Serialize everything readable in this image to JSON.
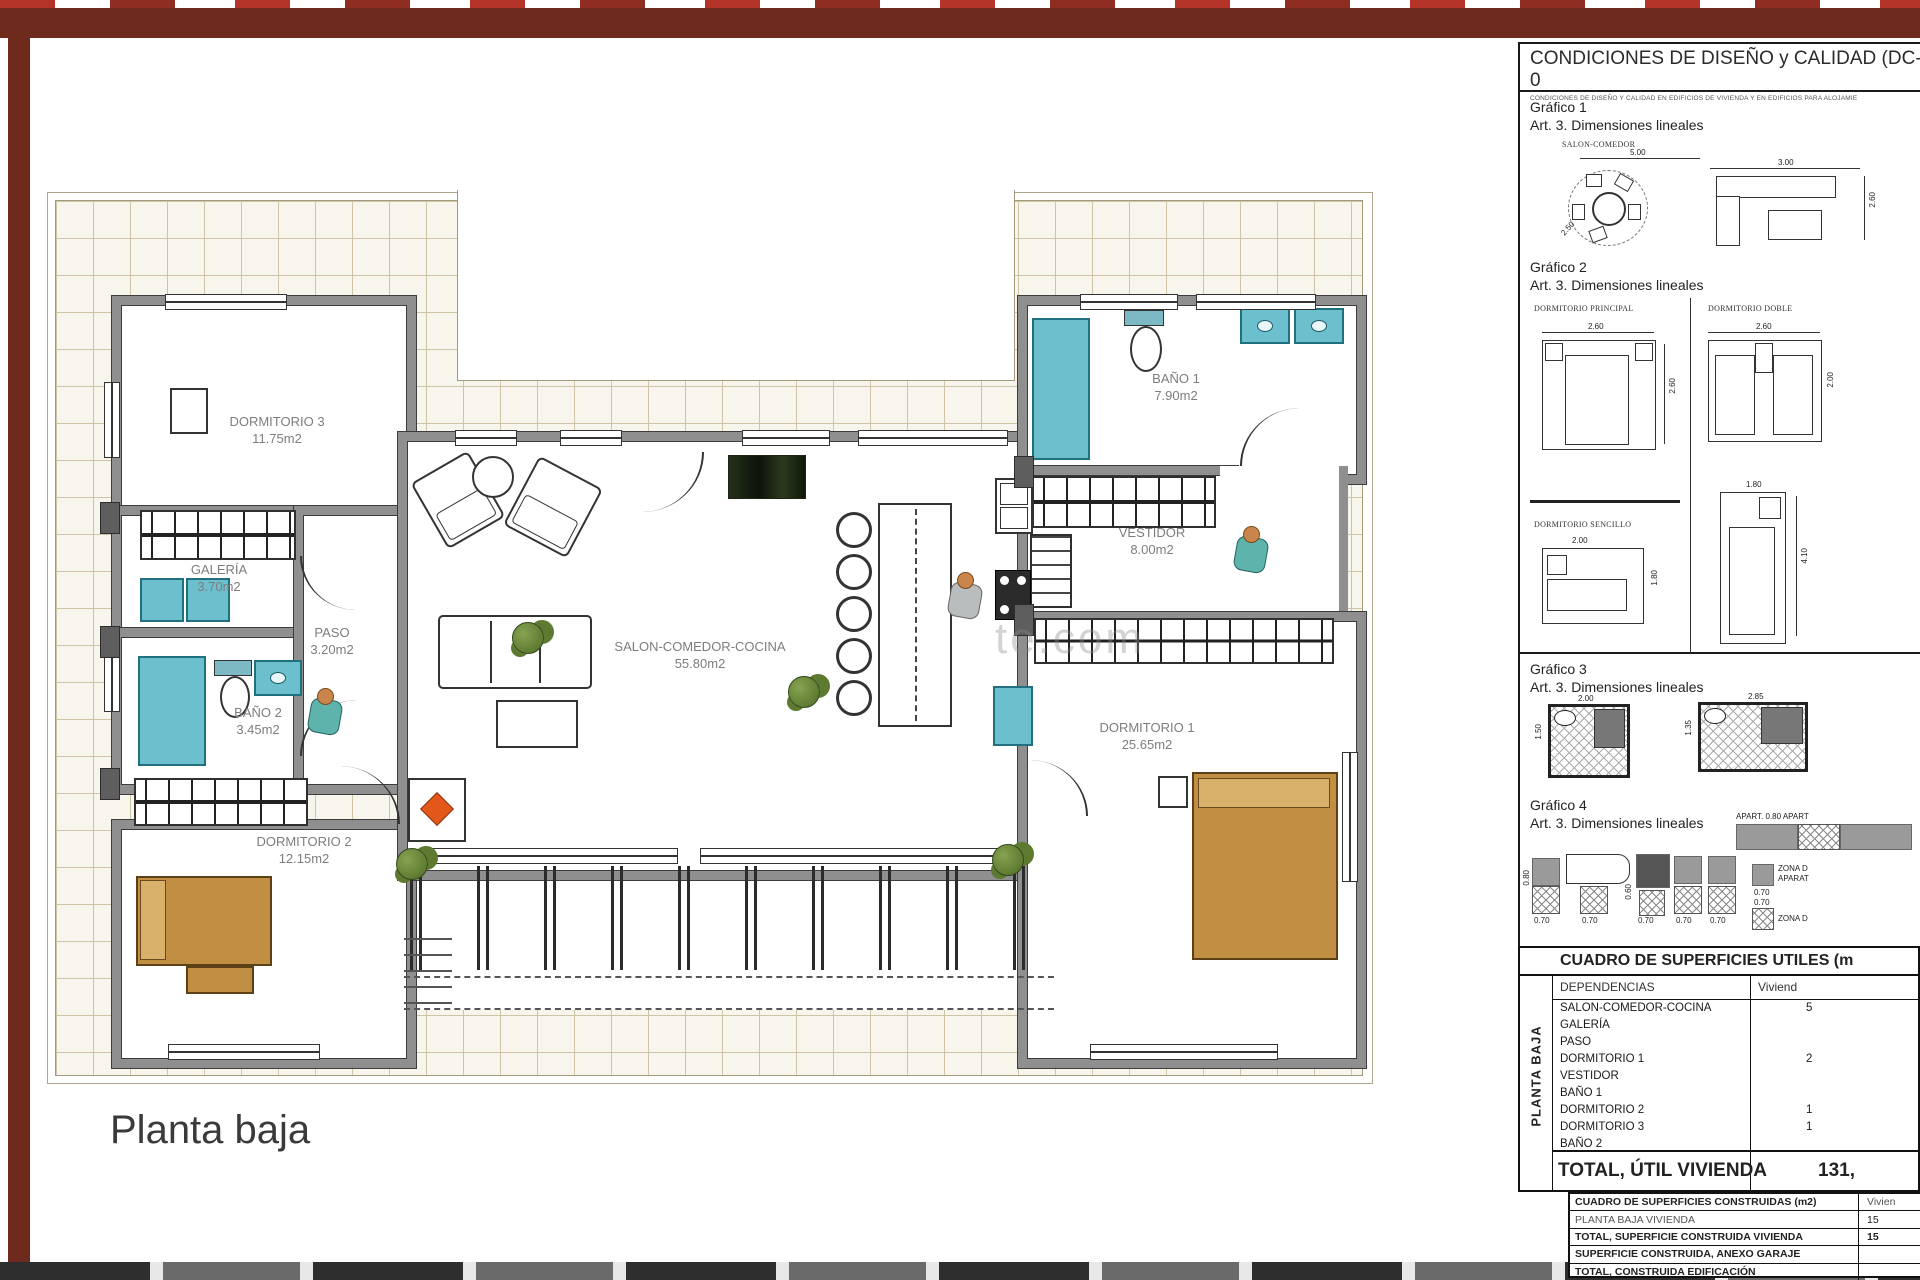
{
  "colors": {
    "frame": "#6e2b1d",
    "accent_red": "#b5342a",
    "teal": "#6cc0cd",
    "bed_brown": "#c08f43",
    "wall_gray": "#8f8f8f",
    "tile_line": "#cfc4a6",
    "label_gray": "#7d7d7d"
  },
  "plan": {
    "floor_label": "Planta baja",
    "watermark": "te.com",
    "rooms": [
      {
        "name": "DORMITORIO 3",
        "area": "11.75m2"
      },
      {
        "name": "GALERÍA",
        "area": "3.70m2"
      },
      {
        "name": "PASO",
        "area": "3.20m2"
      },
      {
        "name": "BAÑO 2",
        "area": "3.45m2"
      },
      {
        "name": "DORMITORIO 2",
        "area": "12.15m2"
      },
      {
        "name": "SALON-COMEDOR-COCINA",
        "area": "55.80m2"
      },
      {
        "name": "BAÑO 1",
        "area": "7.90m2"
      },
      {
        "name": "VESTIDOR",
        "area": "8.00m2"
      },
      {
        "name": "DORMITORIO 1",
        "area": "25.65m2"
      }
    ]
  },
  "panel": {
    "title": "CONDICIONES DE DISEÑO y CALIDAD (DC-0",
    "subtitle": "CONDICIONES DE DISEÑO Y CALIDAD EN EDIFICIOS DE VIVIENDA Y EN EDIFICIOS PARA ALOJAMIE",
    "graficos": [
      {
        "name": "Gráfico 1",
        "law": "Art. 3. Dimensiones lineales",
        "caption": "SALON-COMEDOR",
        "dim_top": "5.00",
        "dim_top2": "3.00",
        "dim_right": "2.60",
        "dim_diag": "2.50"
      },
      {
        "name": "Gráfico 2",
        "law": "Art. 3. Dimensiones lineales",
        "principal": "DORMITORIO PRINCIPAL",
        "doble": "DORMITORIO DOBLE",
        "sencillo": "DORMITORIO SENCILLO",
        "dims": {
          "principal_w": "2.60",
          "principal_h": "2.60",
          "doble_w": "2.60",
          "doble_h": "2.00",
          "single_w": "1.80",
          "single_h": "4.10",
          "sencillo_w": "2.00",
          "sencillo_h": "1.80"
        }
      },
      {
        "name": "Gráfico 3",
        "law": "Art. 3. Dimensiones lineales",
        "bath1_w": "2.00",
        "bath1_h": "1.50",
        "bath2_w": "2.85",
        "bath2_h": "1.35"
      },
      {
        "name": "Gráfico 4",
        "law": "Art. 3. Dimensiones lineales",
        "apart_label": "APART. 0.80 APART",
        "zona1": "ZONA D",
        "zona1b": "APARAT",
        "zona2": "ZONA D",
        "bottom_dims": [
          "0.70",
          "0.70",
          "0.70",
          "0.70",
          "0.70"
        ],
        "left_dim": "0.80",
        "mid_dim": "0.60",
        "legend_dims": [
          "0.70",
          "0.70"
        ]
      }
    ],
    "surfaces": {
      "title": "CUADRO DE SUPERFICIES UTILES (m",
      "col_dep": "DEPENDENCIAS",
      "col_viv": "Viviend",
      "group": "PLANTA BAJA",
      "rows": [
        {
          "dep": "SALON-COMEDOR-COCINA",
          "val": "5"
        },
        {
          "dep": "GALERÍA",
          "val": ""
        },
        {
          "dep": "PASO",
          "val": ""
        },
        {
          "dep": "DORMITORIO 1",
          "val": "2"
        },
        {
          "dep": "VESTIDOR",
          "val": ""
        },
        {
          "dep": "BAÑO 1",
          "val": ""
        },
        {
          "dep": "DORMITORIO 2",
          "val": "1"
        },
        {
          "dep": "DORMITORIO 3",
          "val": "1"
        },
        {
          "dep": "BAÑO 2",
          "val": ""
        }
      ],
      "total_label": "TOTAL, ÚTIL VIVIENDA",
      "total_val": "131,"
    },
    "built": {
      "title": "CUADRO DE SUPERFICIES CONSTRUIDAS (m2)",
      "col_viv": "Vivien",
      "rows": [
        {
          "label": "PLANTA BAJA VIVIENDA",
          "val": "15"
        },
        {
          "label": "TOTAL, SUPERFICIE CONSTRUIDA VIVIENDA",
          "val": "15"
        },
        {
          "label": "SUPERFICIE CONSTRUIDA, ANEXO GARAJE",
          "val": ""
        },
        {
          "label": "TOTAL, CONSTRUIDA EDIFICACIÓN",
          "val": ""
        }
      ]
    }
  }
}
